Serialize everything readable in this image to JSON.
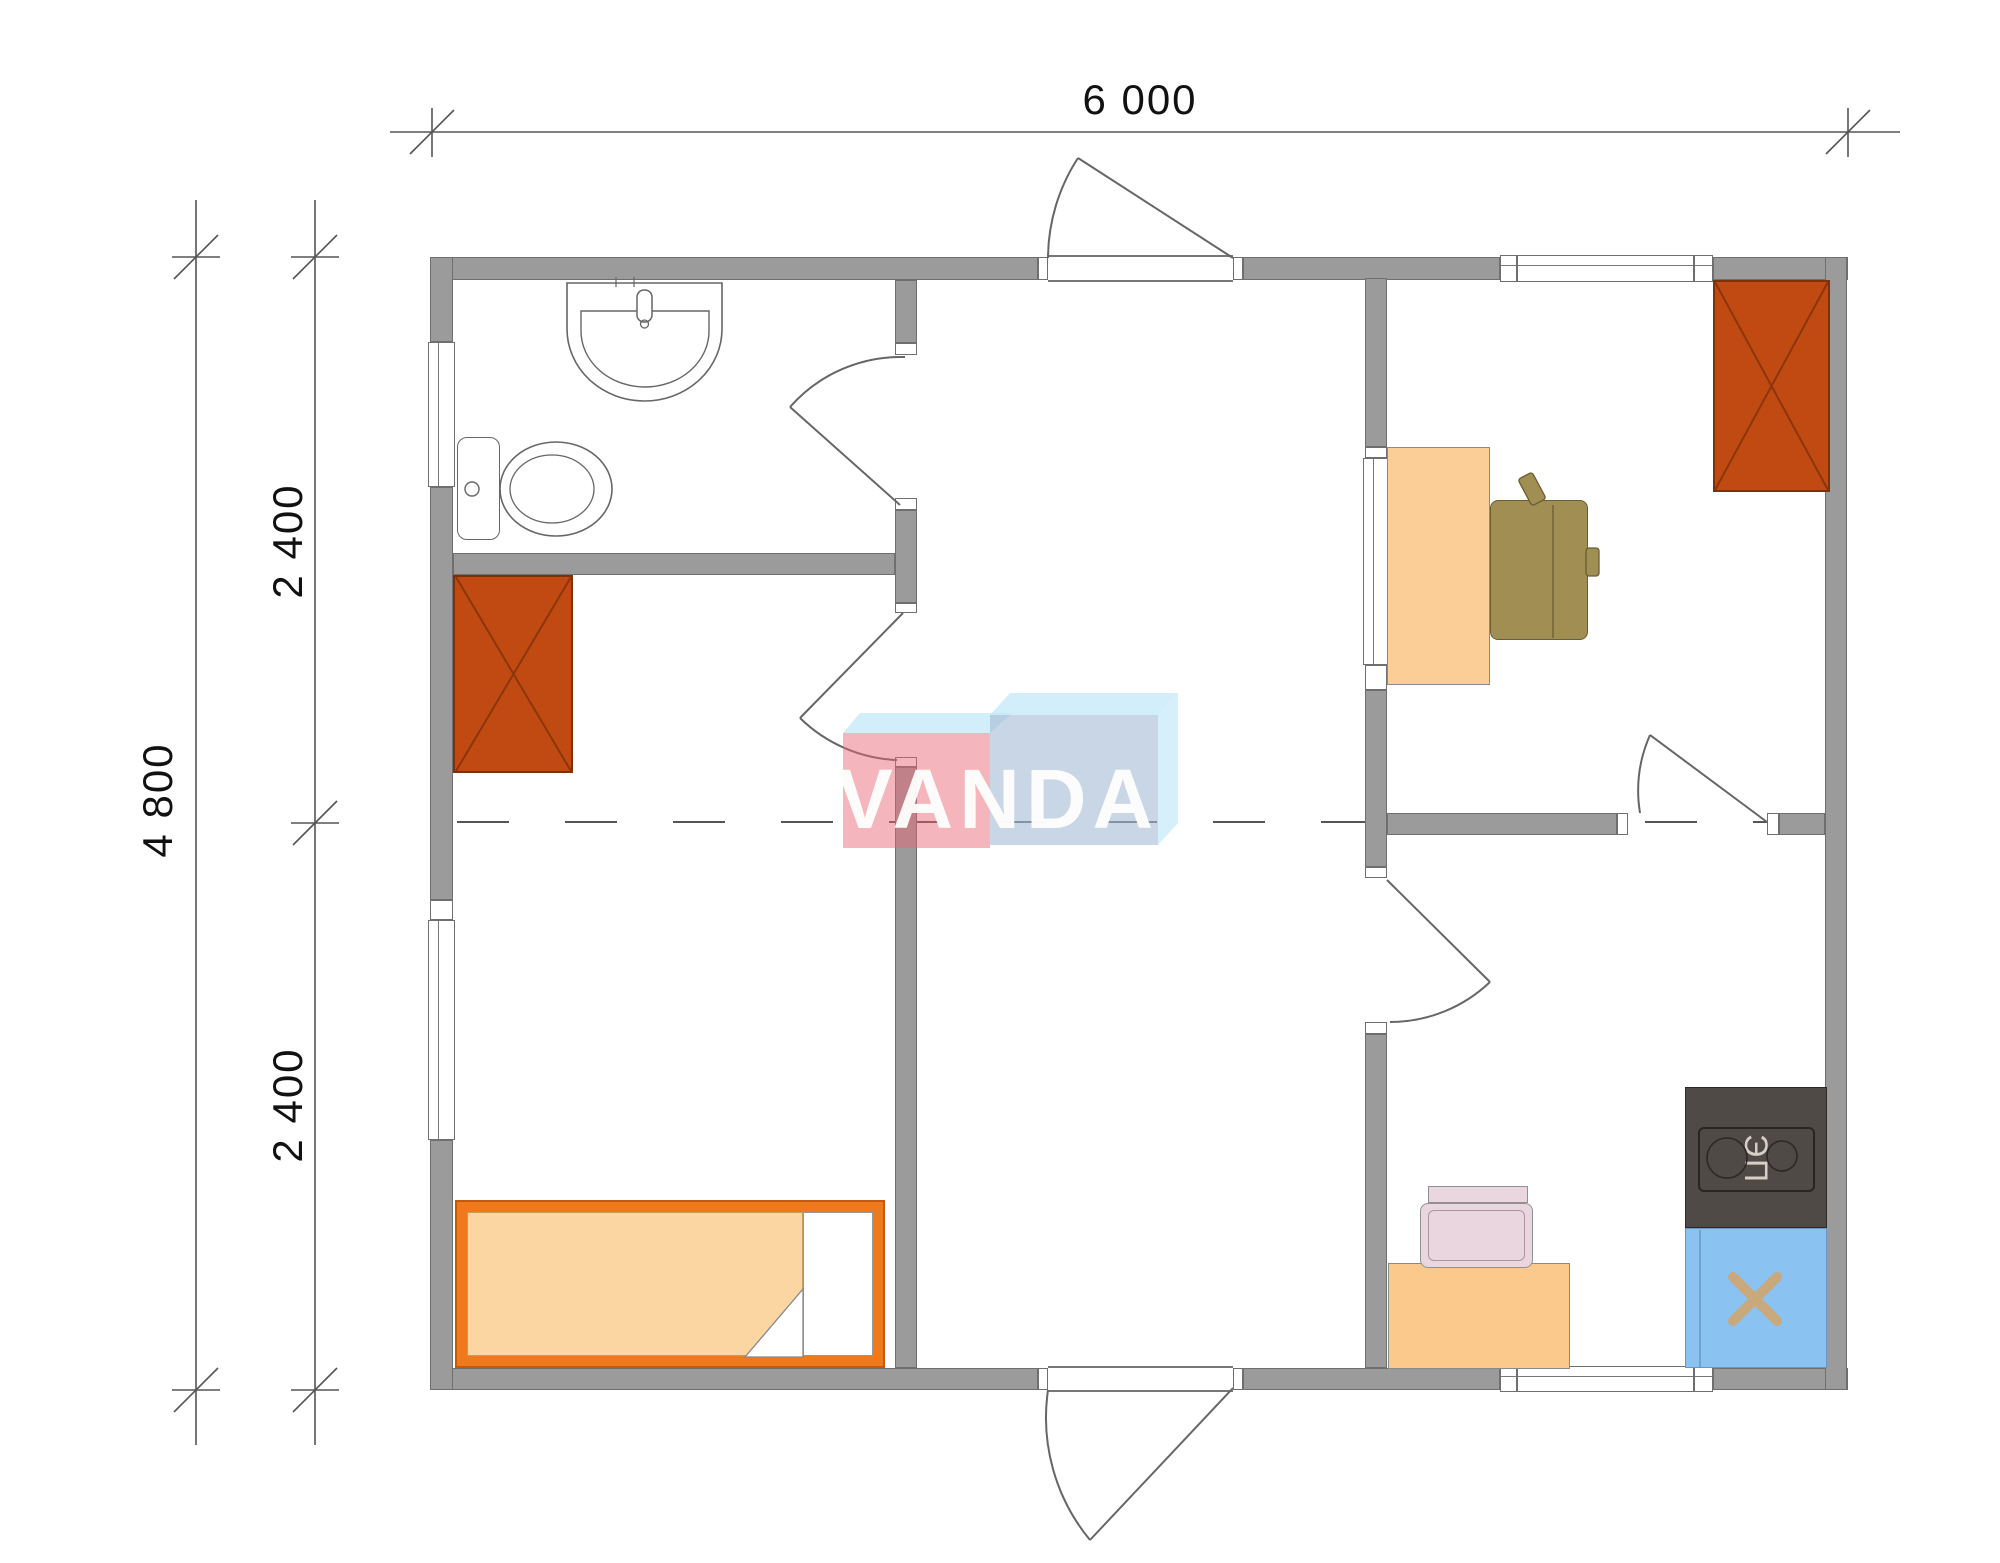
{
  "drawing": {
    "type": "floor-plan",
    "background": "#ffffff"
  },
  "dimensions": {
    "width_label": "6 000",
    "height_total_label": "4 800",
    "height_upper_label": "2 400",
    "height_lower_label": "2 400"
  },
  "watermark": {
    "text": "VANDA",
    "pink": "#e96574",
    "blue": "#a4bad3",
    "cyan": "#c4e9f9",
    "letter_color": "#ffffff"
  },
  "kitchen": {
    "stove_label": "ЭП"
  },
  "colors": {
    "wall_fill": "#9b9b9b",
    "wall_edge": "#6f6f6f",
    "drawing_line": "#666666",
    "wardrobe": "#c14a12",
    "wardrobe_cross": "#8b3509",
    "bed_frame": "#f0791c",
    "mattress": "#fbd5a2",
    "office_desk": "#fbce97",
    "kitchen_desk": "#fbc98c",
    "office_chair": "#a08e52",
    "stove_body": "#4f4a45",
    "kitchen_sink": "#8ac2f2",
    "sink_cross": "#c9a87c",
    "pink_chair": "#e9d6de"
  }
}
